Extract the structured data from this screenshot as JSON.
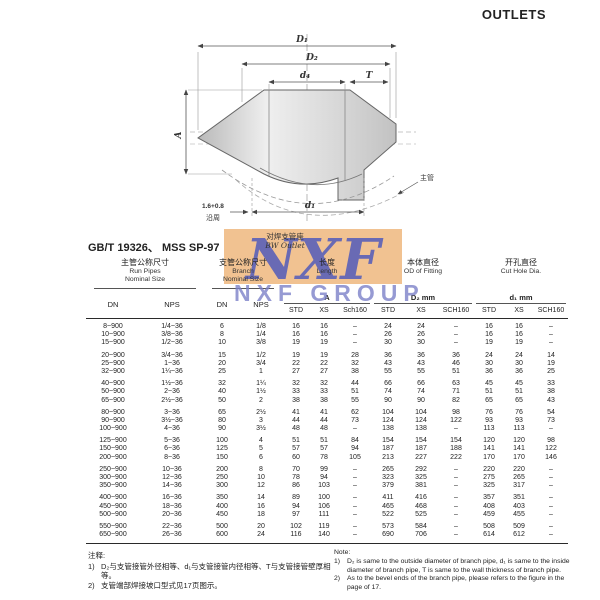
{
  "page": {
    "title": "OUTLETS",
    "standard": "GB/T 19326、 MSS SP-97"
  },
  "diagram": {
    "labels": {
      "d1_top": "D₁",
      "d2": "D₂",
      "d4": "d₄",
      "t": "T",
      "a": "A",
      "weld": "1.6+0.8",
      "weld_note": "沿周",
      "d1_bottom": "d₁",
      "run_pipe": "主管"
    },
    "caption_cn": "对焊支管座",
    "caption_en": "BW Outlet"
  },
  "watermark": {
    "logo": "NXF",
    "name": "NXF GROUP",
    "bg_color": "#f1c291",
    "logo_color": "#5e63b7"
  },
  "table": {
    "groups": [
      {
        "cn": "主管公称尺寸",
        "en": [
          "Run Pipes",
          "Nominal Size"
        ]
      },
      {
        "cn": "支管公称尺寸",
        "en": [
          "Branch",
          "Nominal Size"
        ]
      },
      {
        "cn": "长度",
        "en": [
          "Length"
        ],
        "dim": "A"
      },
      {
        "cn": "本体直径",
        "en": [
          "OD of Fitting"
        ],
        "dim": "D₂ mm"
      },
      {
        "cn": "开孔直径",
        "en": [
          "Cut Hole Dia."
        ],
        "dim": "d₁ mm"
      }
    ],
    "subheaders": {
      "dn": "DN",
      "nps": "NPS",
      "std": "STD",
      "xs": "XS",
      "sch160_a": "Sch160",
      "sch160": "SCH160"
    },
    "row_groups": [
      [
        [
          "8~900",
          "1/4~36",
          "6",
          "1/8",
          "16",
          "16",
          "–",
          "24",
          "24",
          "–",
          "16",
          "16",
          "–"
        ],
        [
          "10~900",
          "3/8~36",
          "8",
          "1/4",
          "16",
          "16",
          "–",
          "26",
          "26",
          "–",
          "16",
          "16",
          "–"
        ],
        [
          "15~900",
          "1/2~36",
          "10",
          "3/8",
          "19",
          "19",
          "–",
          "30",
          "30",
          "–",
          "19",
          "19",
          "–"
        ]
      ],
      [
        [
          "20~900",
          "3/4~36",
          "15",
          "1/2",
          "19",
          "19",
          "28",
          "36",
          "36",
          "36",
          "24",
          "24",
          "14"
        ],
        [
          "25~900",
          "1~36",
          "20",
          "3/4",
          "22",
          "22",
          "32",
          "43",
          "43",
          "46",
          "30",
          "30",
          "19"
        ],
        [
          "32~900",
          "1¼~36",
          "25",
          "1",
          "27",
          "27",
          "38",
          "55",
          "55",
          "51",
          "36",
          "36",
          "25"
        ]
      ],
      [
        [
          "40~900",
          "1½~36",
          "32",
          "1¼",
          "32",
          "32",
          "44",
          "66",
          "66",
          "63",
          "45",
          "45",
          "33"
        ],
        [
          "50~900",
          "2~36",
          "40",
          "1½",
          "33",
          "33",
          "51",
          "74",
          "74",
          "71",
          "51",
          "51",
          "38"
        ],
        [
          "65~900",
          "2½~36",
          "50",
          "2",
          "38",
          "38",
          "55",
          "90",
          "90",
          "82",
          "65",
          "65",
          "43"
        ]
      ],
      [
        [
          "80~900",
          "3~36",
          "65",
          "2½",
          "41",
          "41",
          "62",
          "104",
          "104",
          "98",
          "76",
          "76",
          "54"
        ],
        [
          "90~900",
          "3½~36",
          "80",
          "3",
          "44",
          "44",
          "73",
          "124",
          "124",
          "122",
          "93",
          "93",
          "73"
        ],
        [
          "100~900",
          "4~36",
          "90",
          "3½",
          "48",
          "48",
          "–",
          "138",
          "138",
          "–",
          "113",
          "113",
          "–"
        ]
      ],
      [
        [
          "125~900",
          "5~36",
          "100",
          "4",
          "51",
          "51",
          "84",
          "154",
          "154",
          "154",
          "120",
          "120",
          "98"
        ],
        [
          "150~900",
          "6~36",
          "125",
          "5",
          "57",
          "57",
          "94",
          "187",
          "187",
          "188",
          "141",
          "141",
          "122"
        ],
        [
          "200~900",
          "8~36",
          "150",
          "6",
          "60",
          "78",
          "105",
          "213",
          "227",
          "222",
          "170",
          "170",
          "146"
        ]
      ],
      [
        [
          "250~900",
          "10~36",
          "200",
          "8",
          "70",
          "99",
          "–",
          "265",
          "292",
          "–",
          "220",
          "220",
          "–"
        ],
        [
          "300~900",
          "12~36",
          "250",
          "10",
          "78",
          "94",
          "–",
          "323",
          "325",
          "–",
          "275",
          "265",
          "–"
        ],
        [
          "350~900",
          "14~36",
          "300",
          "12",
          "86",
          "103",
          "–",
          "379",
          "381",
          "–",
          "325",
          "317",
          "–"
        ]
      ],
      [
        [
          "400~900",
          "16~36",
          "350",
          "14",
          "89",
          "100",
          "–",
          "411",
          "416",
          "–",
          "357",
          "351",
          "–"
        ],
        [
          "450~900",
          "18~36",
          "400",
          "16",
          "94",
          "106",
          "–",
          "465",
          "468",
          "–",
          "408",
          "403",
          "–"
        ],
        [
          "500~900",
          "20~36",
          "450",
          "18",
          "97",
          "111",
          "–",
          "522",
          "525",
          "–",
          "459",
          "455",
          "–"
        ]
      ],
      [
        [
          "550~900",
          "22~36",
          "500",
          "20",
          "102",
          "119",
          "–",
          "573",
          "584",
          "–",
          "508",
          "509",
          "–"
        ],
        [
          "650~900",
          "26~36",
          "600",
          "24",
          "116",
          "140",
          "–",
          "690",
          "706",
          "–",
          "614",
          "612",
          "–"
        ]
      ]
    ]
  },
  "notes": {
    "cn_title": "注释:",
    "cn": [
      {
        "mk": "1)",
        "tx": "D₂与支管接管外径相等、d₁与支管接管内径相等、T与支管接管壁厚相等。"
      },
      {
        "mk": "2)",
        "tx": "支管端部焊接坡口型式见17页图示。"
      }
    ],
    "en_title": "Note:",
    "en": [
      {
        "mk": "1)",
        "tx": "D₂ is same to the outside diameter of branch pipe, d₁ is same to the inside diameter of branch pipe, T is same to the wall thickness of branch pipe."
      },
      {
        "mk": "2)",
        "tx": "As to the bevel ends of the branch pipe, please refers to the figure in the page of 17."
      }
    ]
  }
}
